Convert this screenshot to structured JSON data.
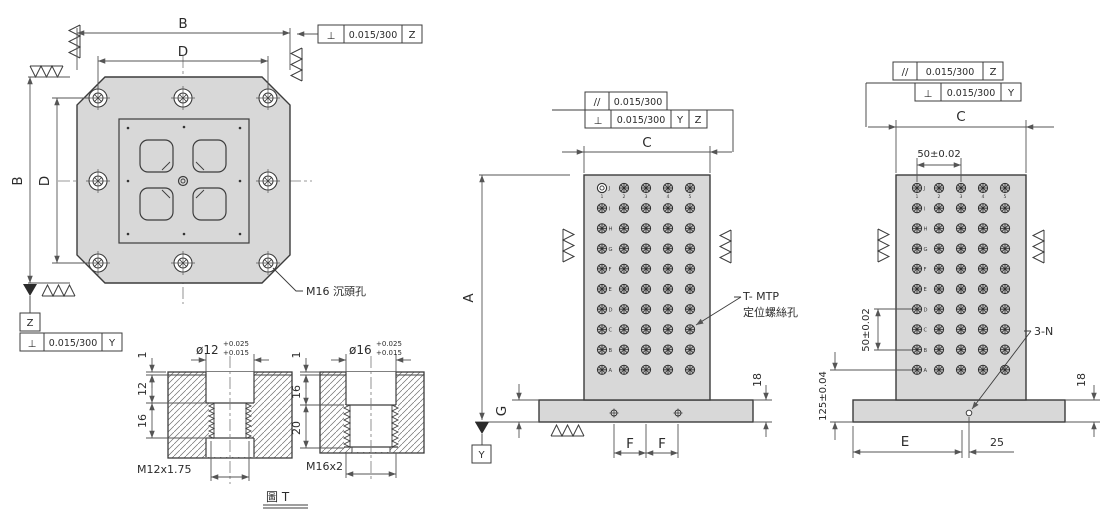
{
  "colors": {
    "part_fill": "#d8d8d8",
    "edge_line": "#3c3c3c",
    "dim_line": "#555555",
    "background": "#ffffff"
  },
  "figure_label": "圖 T",
  "top_view": {
    "dim_b_top": "B",
    "dim_d_top": "D",
    "dim_b_left": "B",
    "dim_d_left": "D",
    "fcf_top": {
      "symbol": "⊥",
      "value": "0.015/300",
      "datum": "Z"
    },
    "datum_label": "Z",
    "fcf_bottom": {
      "symbol": "⊥",
      "value": "0.015/300",
      "datum": "Y"
    },
    "note_counterbore": "M16 沉頭孔"
  },
  "detail_m12": {
    "diameter": "ø12",
    "tol_upper": "+0.025",
    "tol_lower": "+0.015",
    "dim_land": "1",
    "dim_bore_depth": "12",
    "dim_thread_depth": "16",
    "thread_spec": "M12x1.75"
  },
  "detail_m16": {
    "diameter": "ø16",
    "tol_upper": "+0.025",
    "tol_lower": "+0.015",
    "dim_land": "1",
    "dim_bore_depth": "16",
    "dim_thread_depth": "20",
    "thread_spec": "M16x2"
  },
  "front_view": {
    "fcf_parallel": {
      "symbol": "//",
      "value": "0.015/300"
    },
    "fcf_perp": {
      "symbol": "⊥",
      "value": "0.015/300",
      "datum_1": "Y",
      "datum_2": "Z"
    },
    "dim_width": "C",
    "dim_height": "A",
    "dim_base_step": "G",
    "dim_f_left": "F",
    "dim_f_right": "F",
    "dim_base_thickness": "18",
    "datum_label": "Y",
    "note_line1": "T- MTP",
    "note_line2": "定位螺絲孔",
    "row_labels": [
      "J",
      "I",
      "H",
      "G",
      "F",
      "E",
      "D",
      "C",
      "B",
      "A"
    ],
    "col_labels": [
      "1",
      "2",
      "3",
      "4",
      "5"
    ]
  },
  "side_view": {
    "fcf_parallel": {
      "symbol": "//",
      "value": "0.015/300",
      "datum": "Z"
    },
    "fcf_perp": {
      "symbol": "⊥",
      "value": "0.015/300",
      "datum": "Y"
    },
    "dim_width": "C",
    "dim_col_pitch": "50±0.02",
    "dim_row_pitch": "50±0.02",
    "dim_bottom_row": "125±0.04",
    "dim_e": "E",
    "dim_offset": "25",
    "dim_base_thickness": "18",
    "note_hole": "3-N",
    "row_labels": [
      "J",
      "I",
      "H",
      "G",
      "F",
      "E",
      "D",
      "C",
      "B",
      "A"
    ],
    "col_labels": [
      "1",
      "2",
      "3",
      "4",
      "5"
    ]
  }
}
